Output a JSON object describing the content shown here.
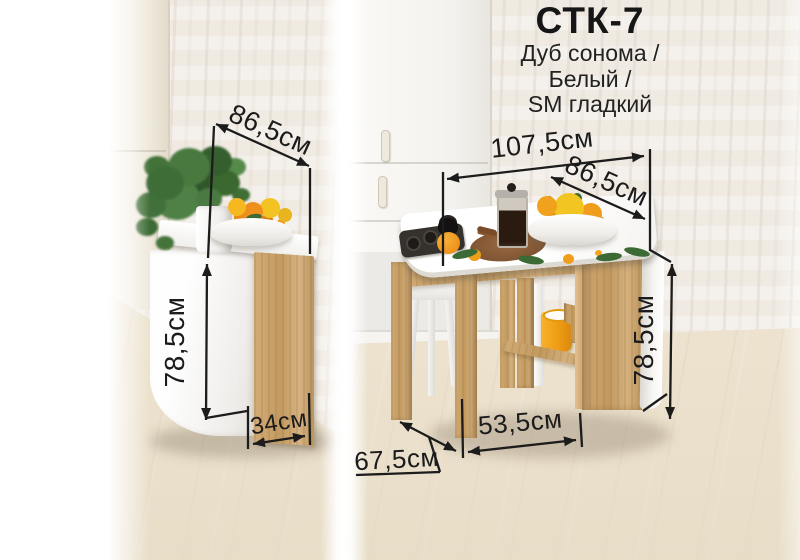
{
  "title": {
    "model": "СТК-7",
    "finish_line1": "Дуб сонома /",
    "finish_line2": "Белый /",
    "finish_line3": "SM гладкий"
  },
  "annotations": {
    "folded": {
      "top_depth": "86,5см",
      "height": "78,5см",
      "width": "34см"
    },
    "unfolded": {
      "length": "107,5см",
      "depth": "86,5см",
      "height": "78,5см",
      "base_width": "53,5см",
      "extension": "67,5см"
    }
  },
  "palette": {
    "annotation_color": "#1c1c1c",
    "wood_sonoma": "#c9a46c",
    "bucket_orange": "#f0a01e",
    "floor": "#eadfc9",
    "wall": "#f1ece5"
  }
}
